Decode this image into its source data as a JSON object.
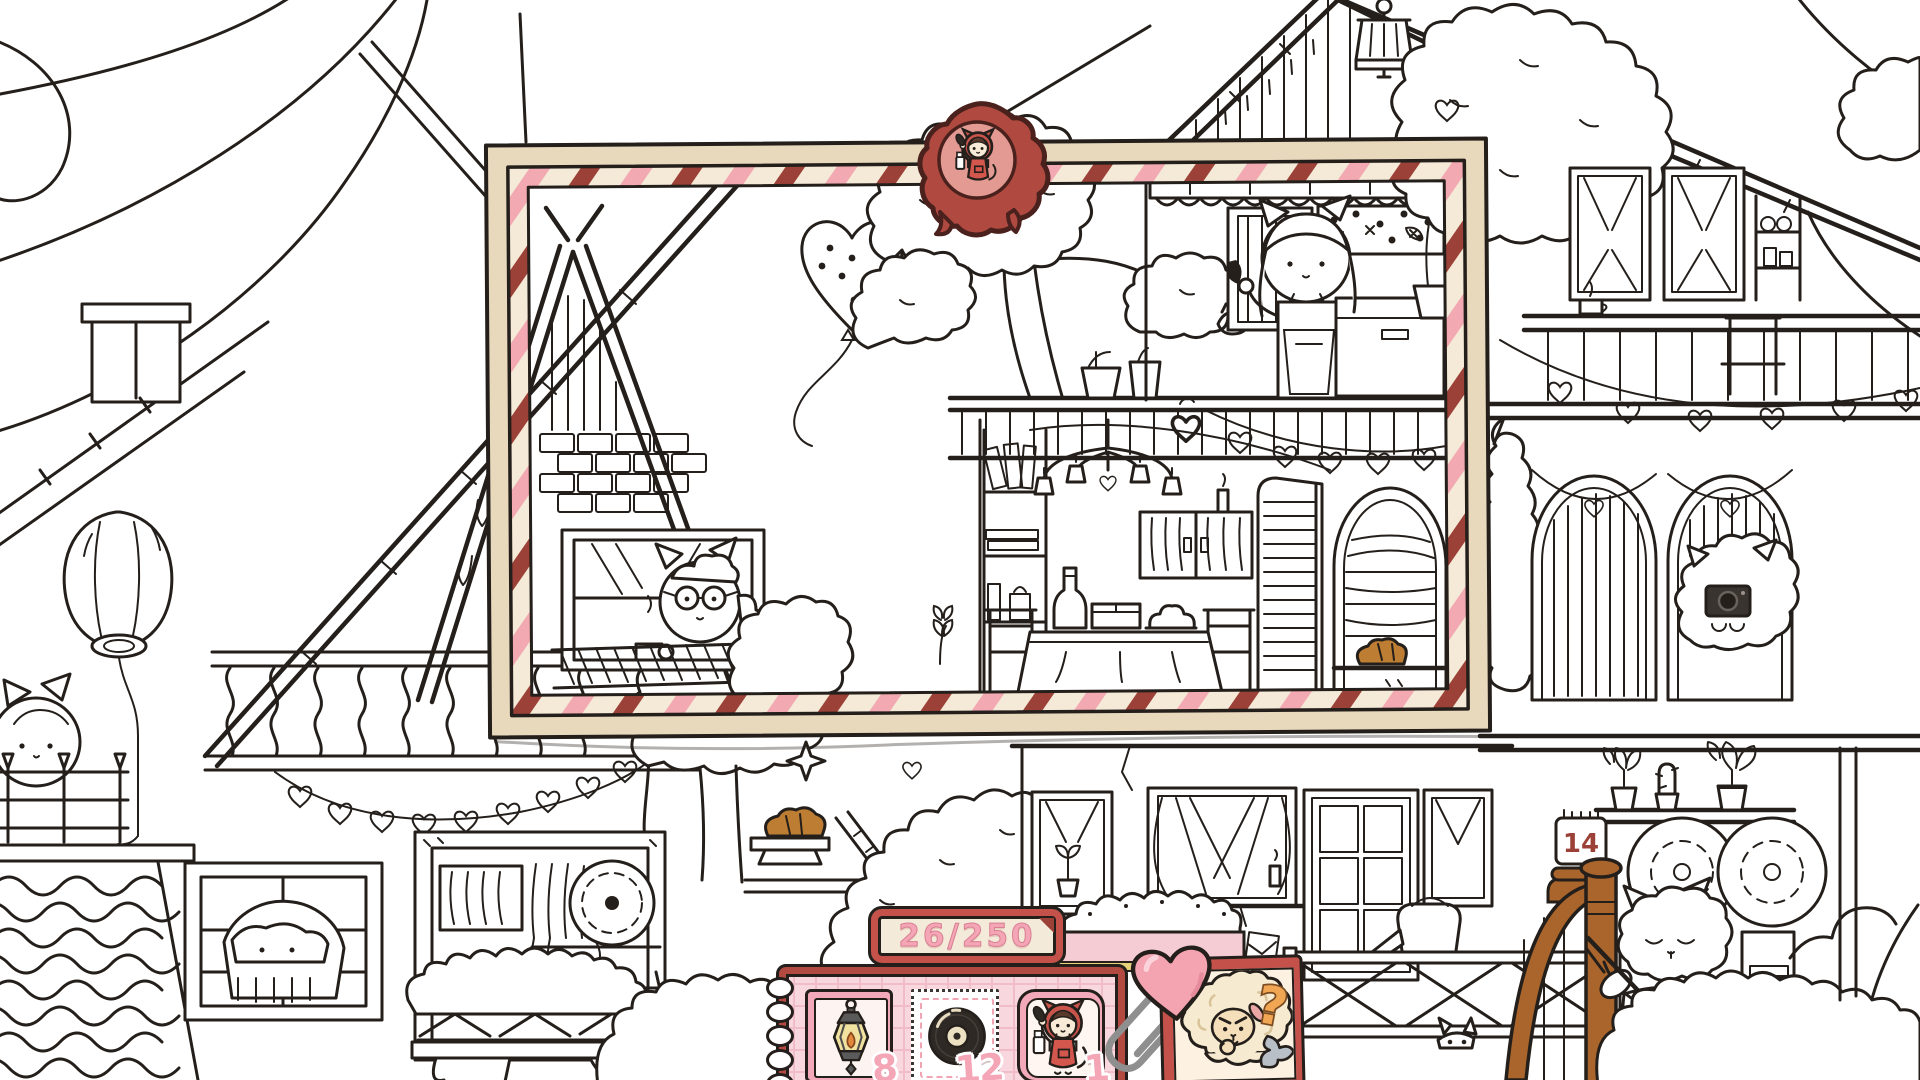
{
  "hud": {
    "progress": {
      "found": "26",
      "total": "250",
      "label": "26/250"
    },
    "items": [
      {
        "id": "lantern",
        "icon": "lantern-icon",
        "count": "8"
      },
      {
        "id": "vinyl-record",
        "icon": "vinyl-record-icon",
        "count": "12"
      },
      {
        "id": "hooded-cat",
        "icon": "hooded-cat-icon",
        "count": "1"
      }
    ],
    "hint": {
      "icon": "sheep-hint-icon",
      "symbol": "?"
    }
  },
  "scene": {
    "calendar_day": "14"
  },
  "colors": {
    "ink": "#241f1b",
    "frame_beige": "#e8d9bd",
    "stripe_cream": "#f4ead7",
    "stripe_pink": "#f2a9b2",
    "stripe_maroon": "#9c4138",
    "wax_red": "#b04a40",
    "ui_red": "#c5514b",
    "panel_cream": "#f3ead9",
    "number_pink": "#f4a6b6",
    "tray_pink": "#f8d7de",
    "heart_pink": "#f4a3b0",
    "clip_gray": "#8f8f8f",
    "sheep_wool": "#f6ead0",
    "question_orange": "#f0a652",
    "wood_brown": "#a9652c",
    "croissant_brown": "#bd7d33"
  }
}
